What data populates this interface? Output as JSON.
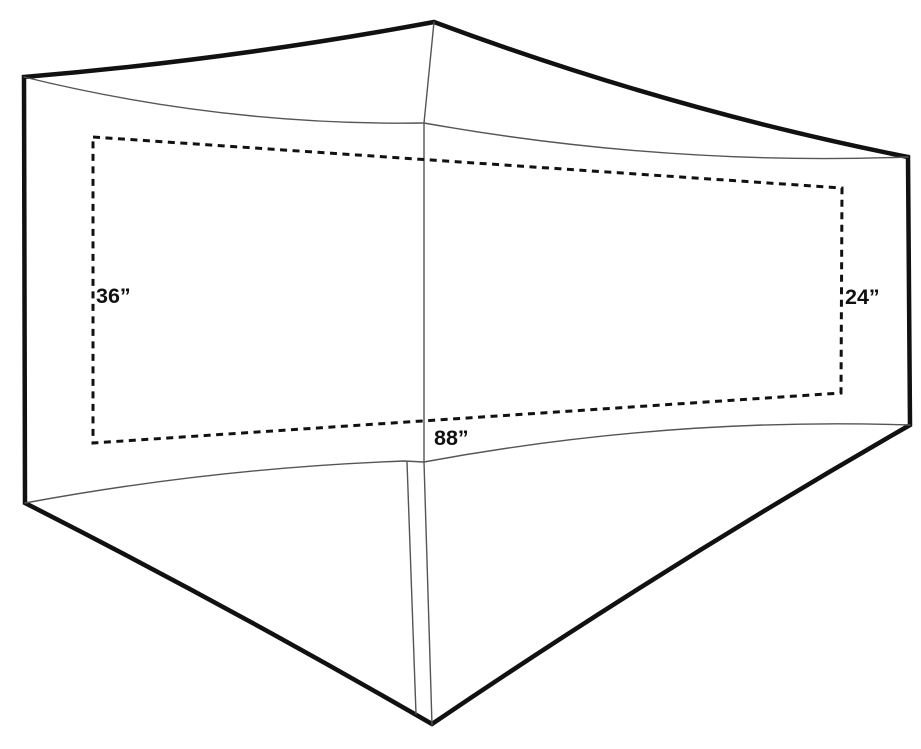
{
  "diagram": {
    "name": "tent-floor-dimension-diagram",
    "description_visible_elements": "line drawing of tent fly footprint with dashed interior floor rectangle and three dimension labels",
    "labels": {
      "left_width": "36”",
      "right_width": "24”",
      "length": "88”"
    },
    "colors": {
      "background": "#ffffff",
      "outline": "#111111",
      "seam": "#555555",
      "dash": "#111111"
    }
  }
}
